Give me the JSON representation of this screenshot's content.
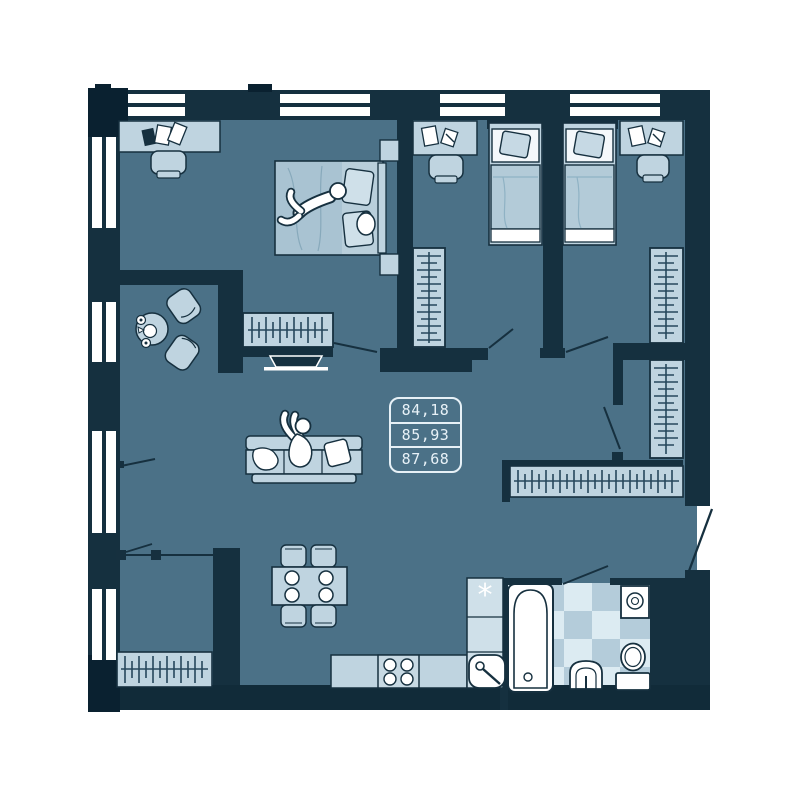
{
  "area_label": {
    "values": [
      "84,18",
      "85,93",
      "87,68"
    ]
  },
  "kitchen": {
    "fridge_symbol": "*"
  },
  "palette": {
    "background": "#ffffff",
    "wall": "#15303f",
    "wall_dark": "#0a2130",
    "floor": "#4b7187",
    "furniture": "#bfd4e0",
    "furniture_shade": "#a9c3d2",
    "item_white": "#ffffff",
    "tile_light": "#dcebf2",
    "tile_dark": "#b4ccda",
    "label_line": "#e7f1f7",
    "hatch_line": "#26475c"
  }
}
